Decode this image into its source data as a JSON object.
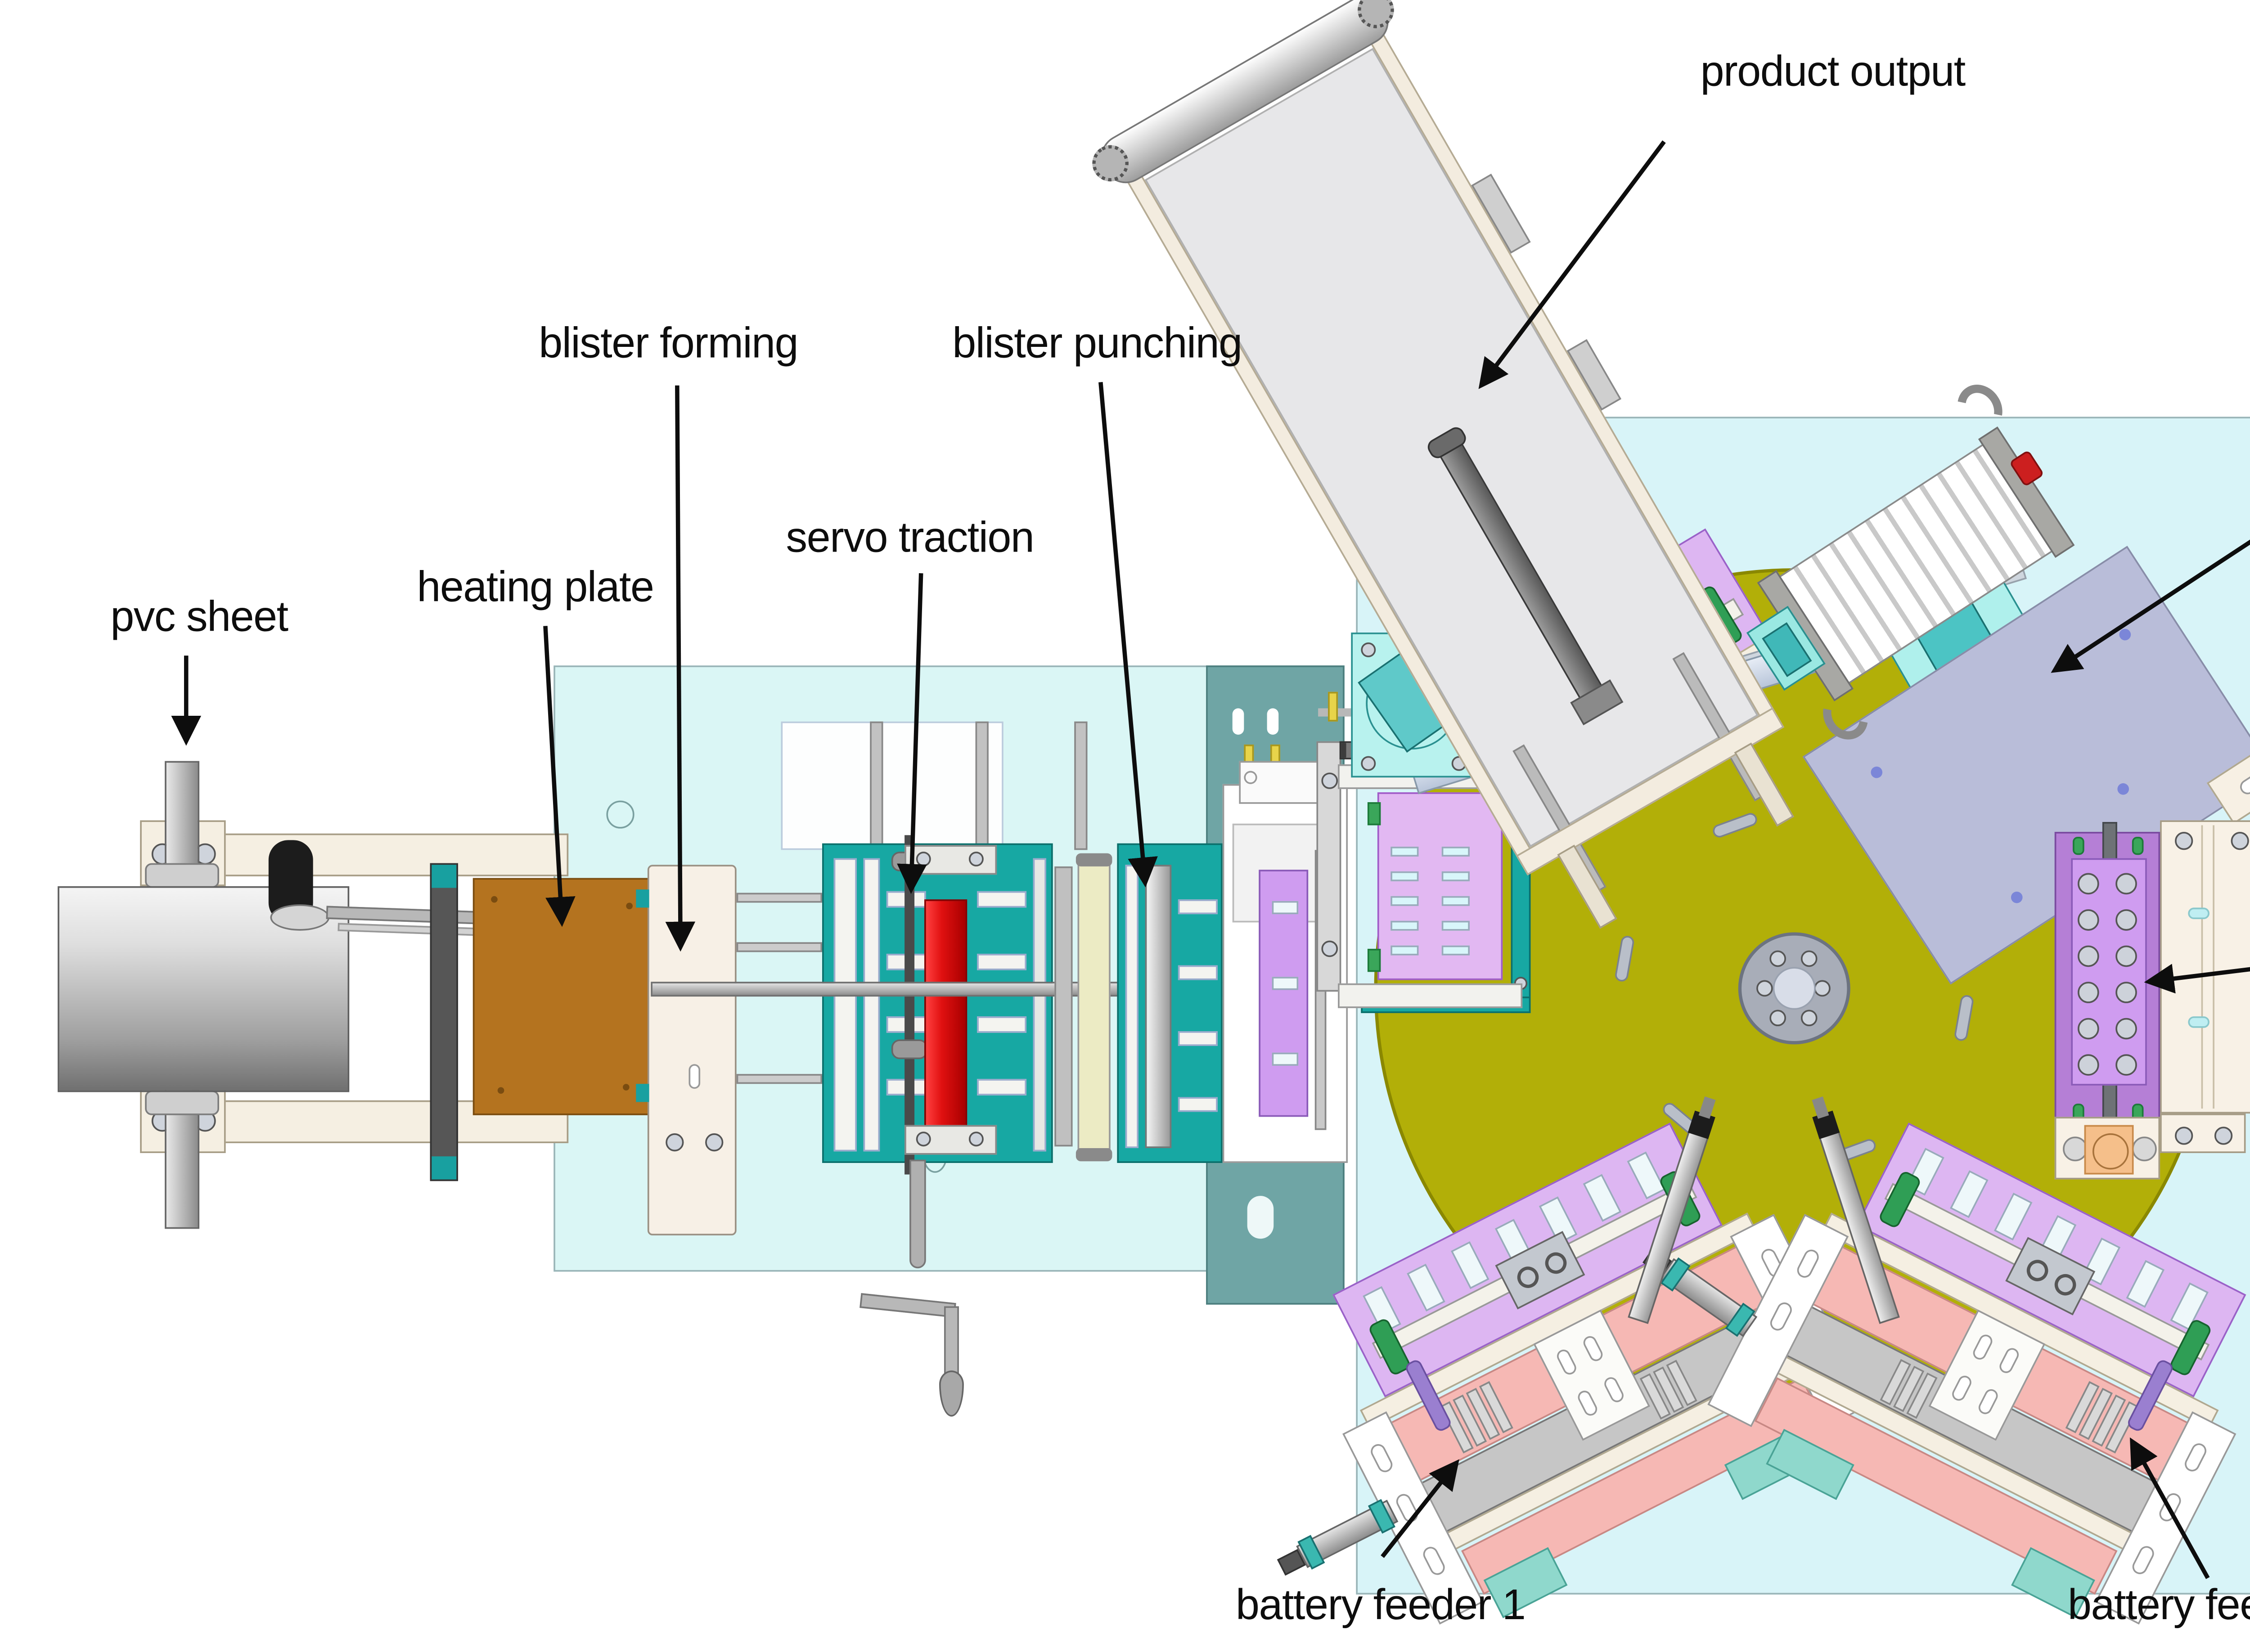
{
  "diagram": {
    "type": "machine-layout",
    "subject": "blister packaging machine top view"
  },
  "labels": {
    "pvc_sheet": "pvc sheet",
    "heating_plate": "heating plate",
    "blister_forming": "blister forming",
    "servo_traction": "servo traction",
    "blister_punching": "blister punching",
    "product_output": "product output",
    "heat_sealing": {
      "l1": "blister-pa-",
      "l2": "percard heat",
      "l3": "sealing"
    },
    "paper_card": {
      "l1": "paper card",
      "l2": "storage"
    },
    "battery_feeder_1": "battery feeder 1",
    "battery_feeder_2": "battery feeder2"
  },
  "colors": {
    "background": "#ffffff",
    "table_cyan": "#daf6f5",
    "platform_cyan": "#d8f4f8",
    "band_teal": "#6fa5a5",
    "machine_teal": "#17a8a3",
    "turntable_olive": "#b2af08",
    "hub_gray": "#a8adb8",
    "heating_plate_brown": "#b4731f",
    "servo_roller_red": "#e01010",
    "station_lavender": "#ddb6f2",
    "storage_purple": "#b57fd6",
    "heat_seal_plate": "#b9bdd9",
    "pad_cyan": "#aef0ec",
    "feeder_pink": "#f6b8b4",
    "feeder_mint": "#8fd8cc",
    "frame_cream": "#f5efe2",
    "accent_green": "#3aa65a",
    "accent_yellow": "#e8d44a",
    "accent_orange": "#f5bf8a",
    "label_text": "#0d0d0d"
  }
}
